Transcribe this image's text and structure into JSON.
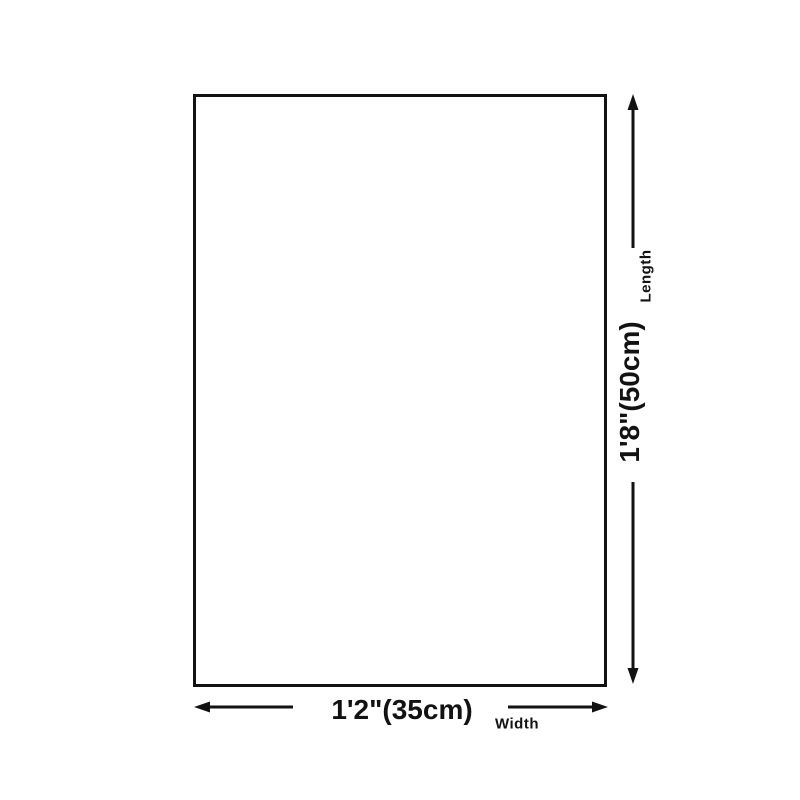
{
  "canvas": {
    "background": "#ffffff",
    "line_color": "#121212"
  },
  "diagram": {
    "length": {
      "value": "1'8\"(50cm)",
      "label": "Length"
    },
    "width": {
      "value": "1'2\"(35cm)",
      "label": "Width"
    },
    "icons": {
      "length_up": "up-arrow-icon",
      "length_down": "down-arrow-icon",
      "width_left": "left-arrow-icon",
      "width_right": "right-arrow-icon"
    }
  }
}
